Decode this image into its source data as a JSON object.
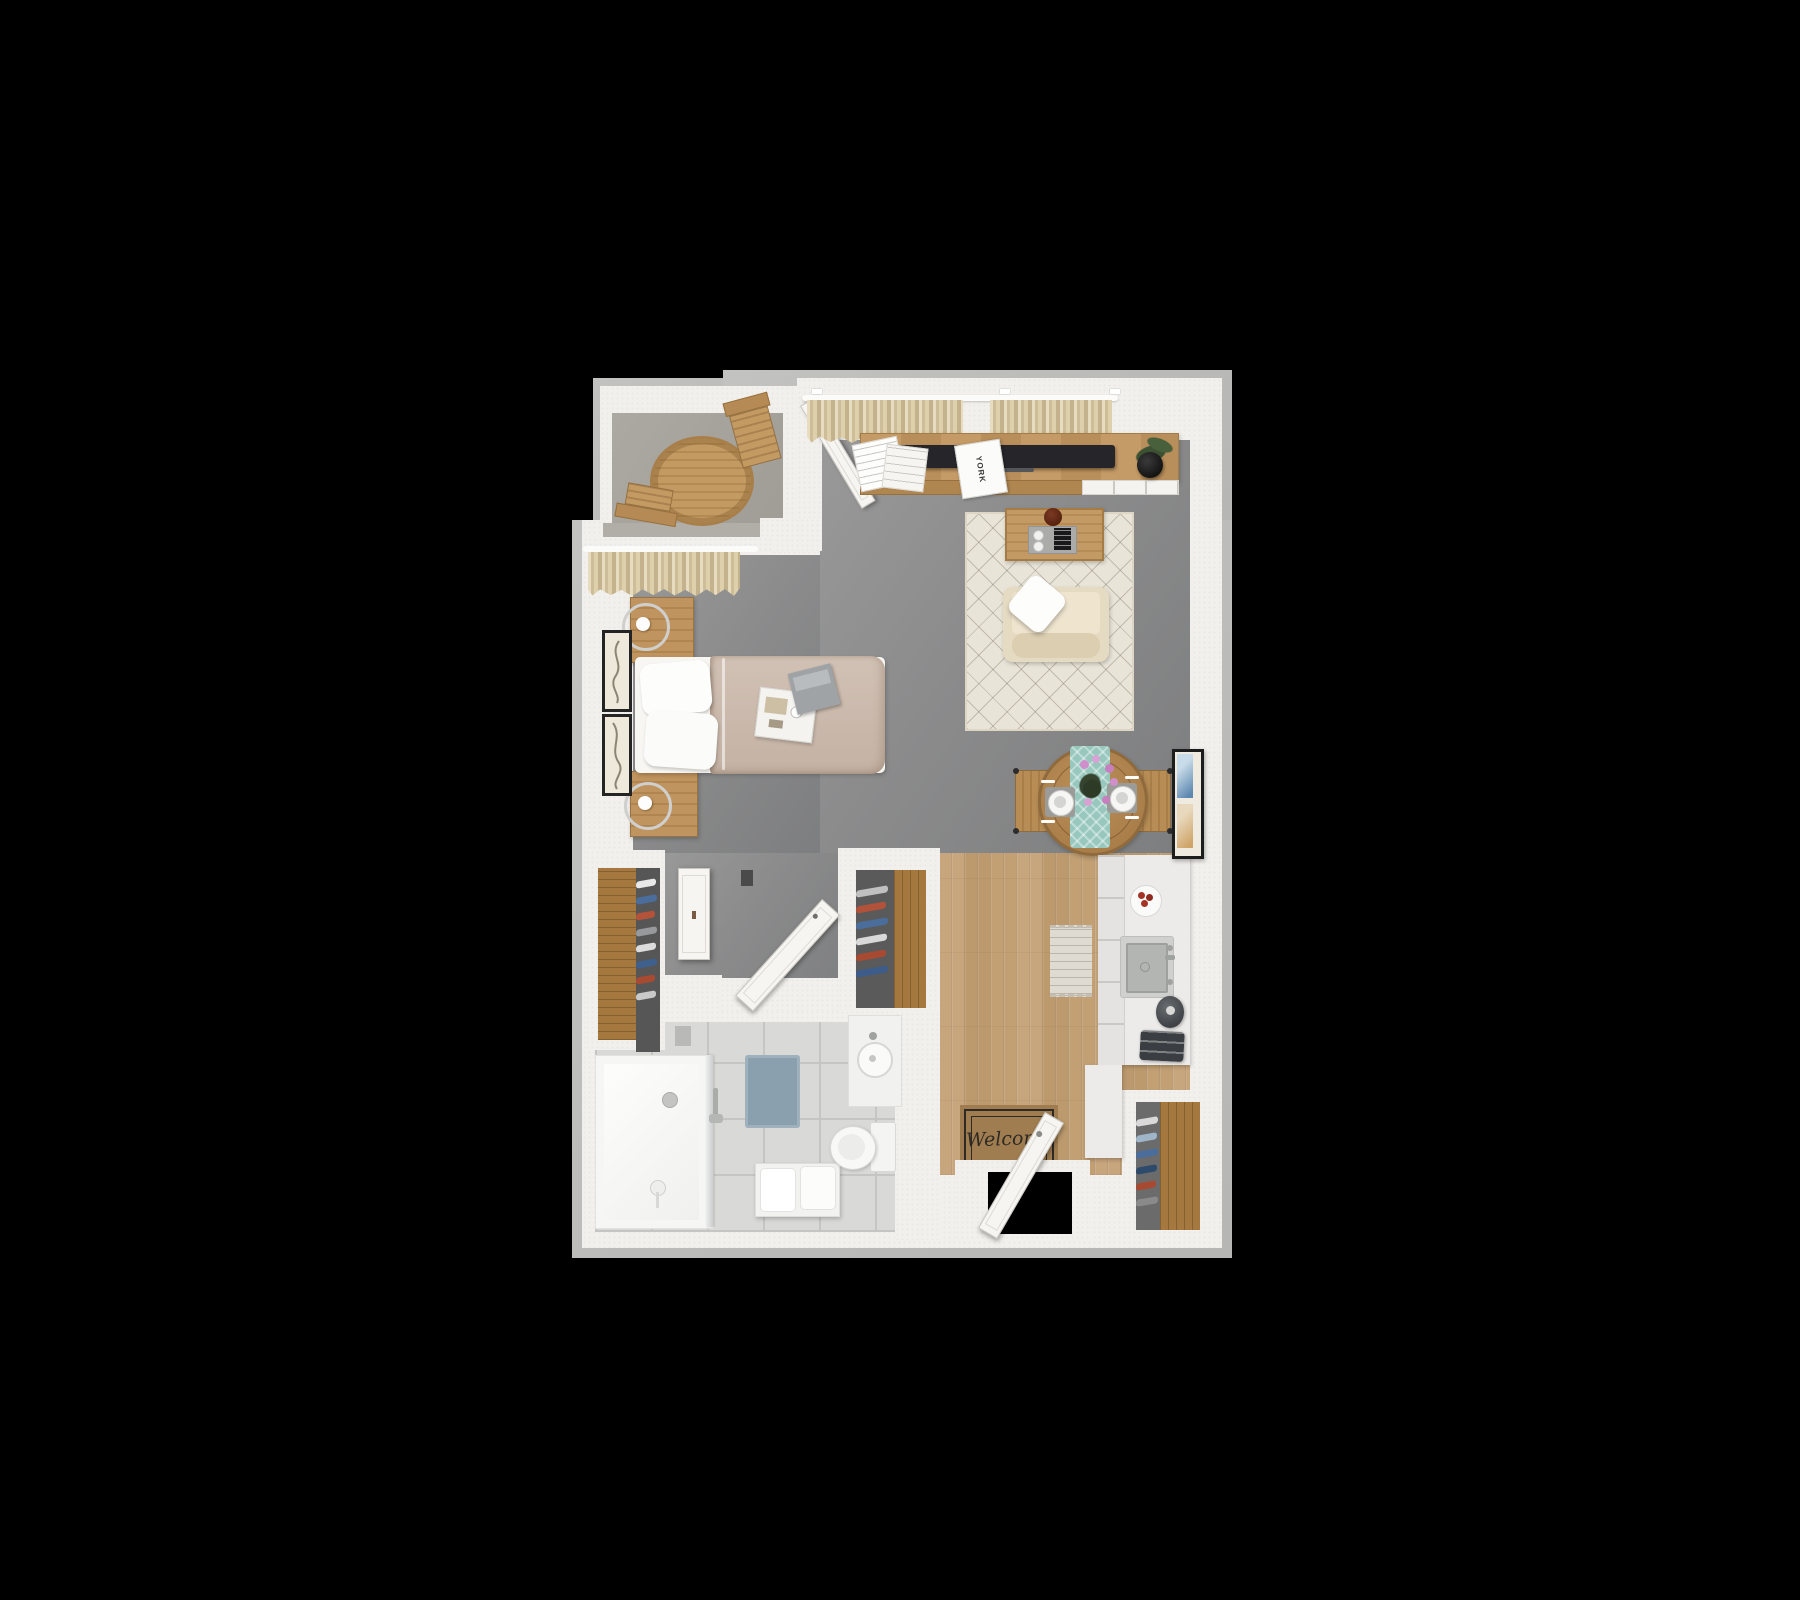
{
  "scene": {
    "description": "3D top-down floor plan rendering of a studio apartment on a black background",
    "background": "#000000"
  },
  "texts": {
    "welcome_mat": "Welcome",
    "magazine_title": "YORK"
  },
  "rooms": [
    "balcony",
    "living-area",
    "sleeping-area",
    "dining-area",
    "kitchen",
    "hallway",
    "bathroom",
    "entry",
    "closets"
  ],
  "furniture": [
    "patio-table",
    "patio-chairs",
    "tv-console",
    "tv",
    "potted-plant",
    "area-rug",
    "coffee-table",
    "armchair",
    "dining-table",
    "dining-chairs",
    "bed",
    "nightstands",
    "lamps",
    "wall-art",
    "kitchen-counter",
    "sink",
    "kettle",
    "toaster",
    "shower",
    "toilet",
    "vanity",
    "towel-bench",
    "welcome-mat",
    "front-door",
    "wardrobes"
  ],
  "colors": {
    "outer_wall": "#bcbcba",
    "inner_wall": "#f2f0ec",
    "carpet": "#8b8b8c",
    "balcony_floor": "#a8a49e",
    "wood_floor": "#c3a077",
    "closet_wood": "#a4783f",
    "tile": "#d9d9d7",
    "rug": "#e9e4d8",
    "blanket": "#cbbaad",
    "linen": "#f7f6f3",
    "armchair": "#e5dac2",
    "wood_furniture": "#b58951",
    "runner": "#97c7bd",
    "counter": "#ecebe9",
    "steel": "#b3b5b3",
    "appliance_dark": "#3a3d41",
    "door": "#f6f5f2",
    "curtain": "#d9c7a2",
    "welcome_mat_bg": "#a07d50",
    "welcome_mat_ink": "#2e2a24",
    "bath_mat": "#8aa0ae",
    "accent_red": "#a33325",
    "accent_blue": "#4a6d9c",
    "plant": "#3d5233",
    "orchid": "#cf8fcb",
    "tv": "#26262a"
  }
}
